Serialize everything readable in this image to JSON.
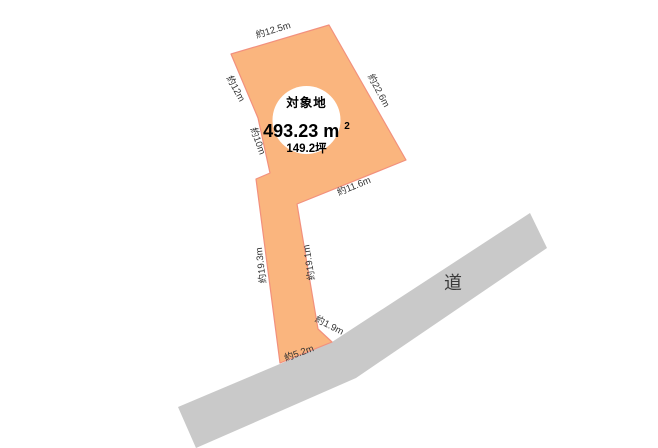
{
  "diagram": {
    "type": "land-plot-site-diagram",
    "colors": {
      "background": "#FFFFFF",
      "parcel_fill": "#FAB57E",
      "parcel_stroke": "#F2907D",
      "road_fill": "#C9C9C9",
      "circle_fill": "#FFFFFF",
      "dimension_text": "#333333",
      "title_text": "#000000"
    },
    "parcel": {
      "name": "対象地",
      "area_value": "493.23",
      "area_unit": "m",
      "area_unit_sup": "2",
      "area_tsubo": "149.2坪"
    },
    "road": {
      "label": "道"
    },
    "dimensions": [
      {
        "edge": "top",
        "label": "約12.5m"
      },
      {
        "edge": "upper-right",
        "label": "約22.6m"
      },
      {
        "edge": "upper-left",
        "label": "約12m"
      },
      {
        "edge": "mid-left",
        "label": "約10m"
      },
      {
        "edge": "inner-diagonal",
        "label": "約11.6m"
      },
      {
        "edge": "strip-right",
        "label": "約19.1m"
      },
      {
        "edge": "strip-left",
        "label": "約19.3m"
      },
      {
        "edge": "road-frontage-short",
        "label": "約1.9m"
      },
      {
        "edge": "road-frontage",
        "label": "約5.2m"
      }
    ]
  }
}
